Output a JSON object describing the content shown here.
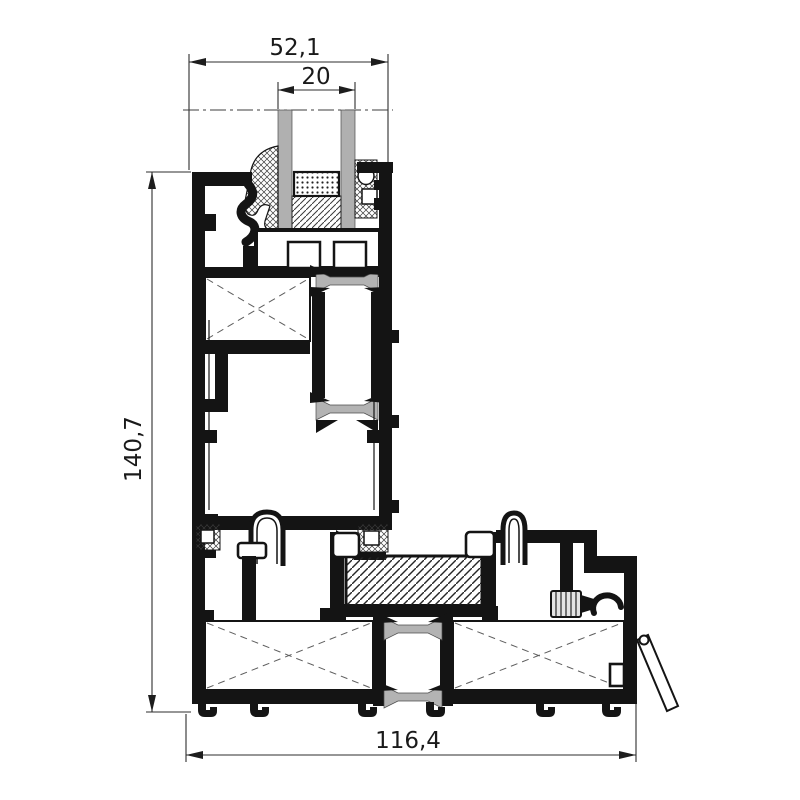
{
  "drawing": {
    "type": "aluminium-profile-cross-section",
    "dimensions": {
      "frame_top_width": "52,1",
      "glazing_thickness": "20",
      "section_height": "140,7",
      "section_bottom_width": "116,4"
    },
    "colors": {
      "outline": "#141414",
      "glass": "#b0b0b0",
      "thermal_break": "#b3b3b3",
      "background": "#ffffff"
    }
  }
}
